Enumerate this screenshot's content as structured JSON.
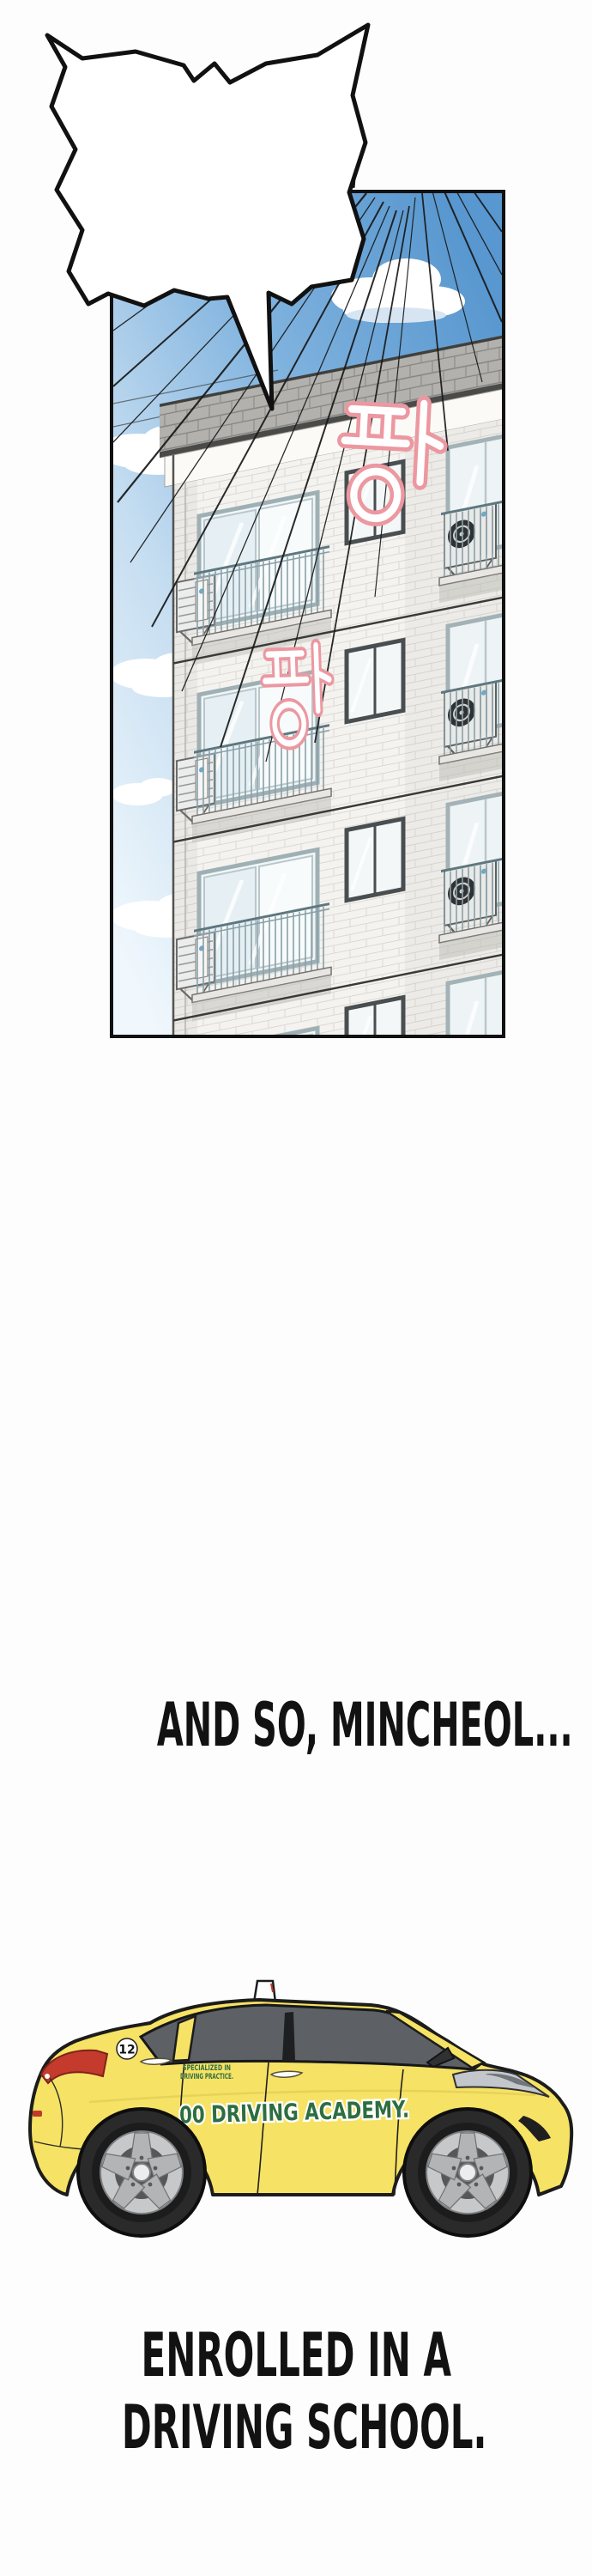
{
  "page": {
    "background": "#fdfdfd"
  },
  "speech_bubble": {
    "text": "AH, COME ON!!",
    "fill": "#ffffff",
    "outline": "#111111"
  },
  "panel": {
    "border_color": "#111111",
    "sky_top_color": "#5897cf",
    "sky_bottom_color": "#f1f8fd",
    "sound_effects": [
      {
        "text": "팡",
        "romanized": "PANG",
        "color": "#ec98a1"
      },
      {
        "text": "팡",
        "romanized": "PANG",
        "color": "#ec98a1"
      }
    ]
  },
  "captions": {
    "middle": "AND SO, MINCHEOL...",
    "bottom_line_1": "ENROLLED IN A",
    "bottom_line_2": "DRIVING SCHOOL."
  },
  "car": {
    "body_color": "#f6e264",
    "badge_number": "12",
    "door_small_text_line_1": "SPECIALIZED IN",
    "door_small_text_line_2": "DRIVING PRACTICE.",
    "door_main_text": "00 DRIVING ACADEMY.",
    "text_color": "#2d6e41",
    "tail_light_color": "#c43a2d"
  }
}
